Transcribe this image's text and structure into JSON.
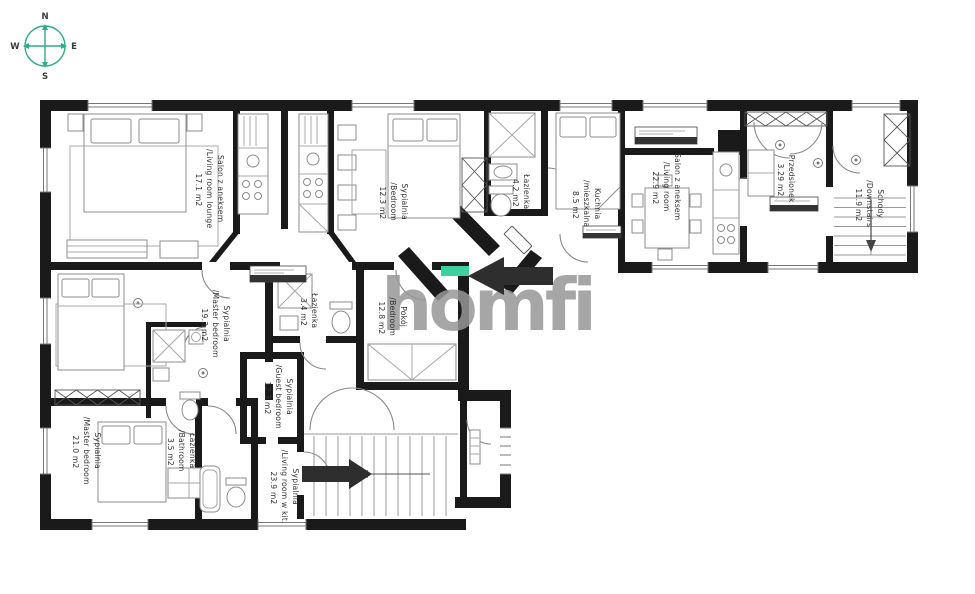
{
  "compass": {
    "n": "N",
    "e": "E",
    "s": "S",
    "w": "W"
  },
  "watermark": {
    "text": "homfi"
  },
  "colors": {
    "wall": "#1a1a1a",
    "furniture": "#8c8c8c",
    "label": "#333333",
    "compass_accent": "#2fa98c",
    "watermark_gray": "#979797",
    "logo_green": "#3fd0a0",
    "arrow_black": "#2e2e2e"
  },
  "rooms": [
    {
      "label_pl": "Salon z aneksem",
      "label_en": "/Living room lounge",
      "area": "17.1 m2"
    },
    {
      "label_pl": "Sypialnia",
      "label_en": "/Bedroom",
      "area": "12.3 m2"
    },
    {
      "label_pl": "Łazienka",
      "label_en": "",
      "area": "4.2 m2"
    },
    {
      "label_pl": "Kuchnia",
      "label_en": "/mieszkalna",
      "area": "8.5 m2"
    },
    {
      "label_pl": "Salon z aneksem",
      "label_en": "/Living room",
      "area": "22.9 m2"
    },
    {
      "label_pl": "Przedsionek",
      "label_en": "",
      "area": "3.29 m2"
    },
    {
      "label_pl": "Schody",
      "label_en": "/Downstairs",
      "area": "11.9 m2"
    },
    {
      "label_pl": "Sypialnia",
      "label_en": "/Master bedroom",
      "area": "19.2 m2"
    },
    {
      "label_pl": "Łazienka",
      "label_en": "",
      "area": "3.4 m2"
    },
    {
      "label_pl": "Pokój",
      "label_en": "/Bedroom",
      "area": "12.8 m2"
    },
    {
      "label_pl": "Sypialnia",
      "label_en": "/Master bedroom",
      "area": "21.0 m2"
    },
    {
      "label_pl": "Łazienka",
      "label_en": "/Bathroom",
      "area": "3.5 m2"
    },
    {
      "label_pl": "Sypialnia",
      "label_en": "/Guest bedroom",
      "area": "12.3 m2"
    },
    {
      "label_pl": "Sypialnia",
      "label_en": "/Living room w kit.",
      "area": "23.9 m2"
    }
  ]
}
